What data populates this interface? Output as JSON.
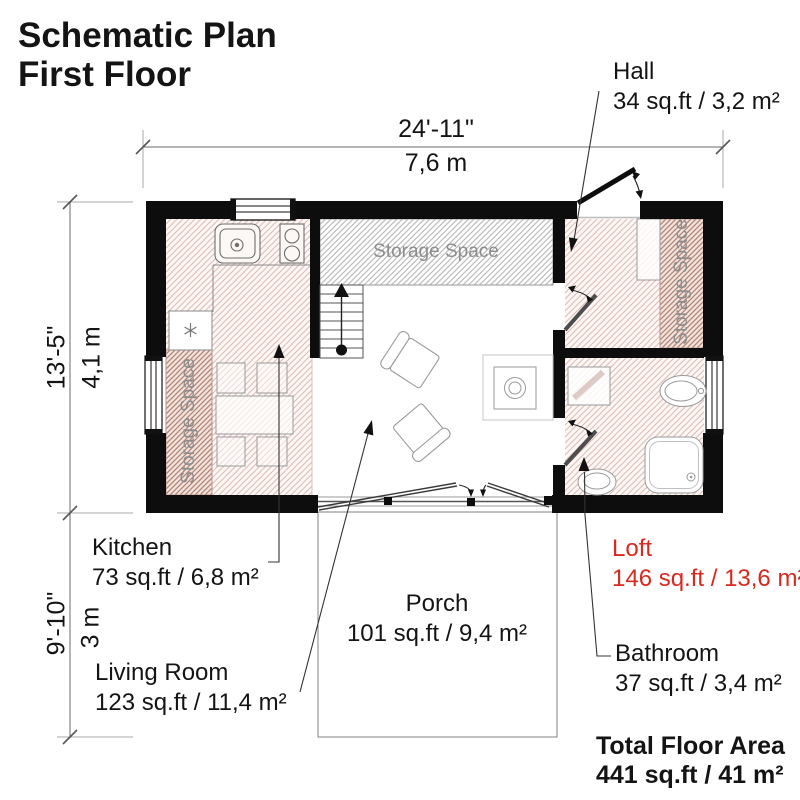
{
  "title": {
    "line1": "Schematic Plan",
    "line2": "First Floor"
  },
  "dimensions": {
    "width": {
      "imperial": "24'-11\"",
      "metric": "7,6 m"
    },
    "height_main": {
      "imperial": "13'-5\"",
      "metric": "4,1 m"
    },
    "height_porch": {
      "imperial": "9'-10\"",
      "metric": "3 m"
    }
  },
  "rooms": {
    "hall": {
      "name": "Hall",
      "area": "34 sq.ft / 3,2 m²"
    },
    "kitchen": {
      "name": "Kitchen",
      "area": "73 sq.ft / 6,8 m²"
    },
    "living_room": {
      "name": "Living Room",
      "area": "123 sq.ft / 11,4 m²"
    },
    "porch": {
      "name": "Porch",
      "area": "101 sq.ft / 9,4 m²"
    },
    "loft": {
      "name": "Loft",
      "area": "146 sq.ft / 13,6 m²"
    },
    "bathroom": {
      "name": "Bathroom",
      "area": "37 sq.ft / 3,4 m²"
    }
  },
  "storage_label": "Storage Space",
  "total": {
    "label": "Total Floor Area",
    "value": "441 sq.ft / 41 m²"
  },
  "colors": {
    "accent_red": "#d8291f",
    "wall": "#0d0d0d",
    "hatch_pink": "#debdb4",
    "hatch_dark": "#b28578",
    "hatch_gray": "#bcbcbc",
    "storage_text": "#8d8d8d"
  }
}
